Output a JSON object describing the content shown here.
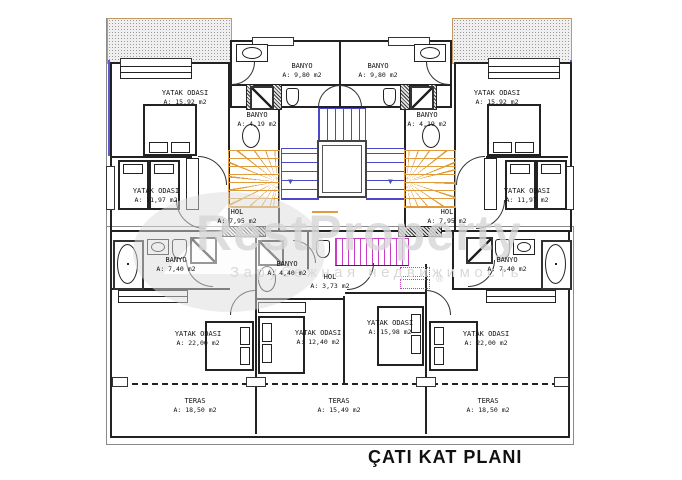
{
  "title": "ÇATI KAT PLANI",
  "watermark": {
    "brand": "RestProperty",
    "subtitle": "Зарубежная недвижимость",
    "registered": "®"
  },
  "colors": {
    "wall": "#222222",
    "stair_blue": "#4a4ac8",
    "stair_orange": "#e09c3c",
    "stair_magenta": "#c83cc8",
    "roof_hatch_edge": "#c49a64",
    "watermark_gray": "#d7d7d7"
  },
  "stairs": {
    "down_arrow": "▼"
  },
  "rooms": [
    {
      "id": "banyo-ust-sol",
      "name": "BANYO",
      "area": "A: 9,80 m2"
    },
    {
      "id": "banyo-ust-sag",
      "name": "BANYO",
      "area": "A: 9,80 m2"
    },
    {
      "id": "yatak-odasi-ust-sol",
      "name": "YATAK ODASI",
      "area": "A: 15,92 m2"
    },
    {
      "id": "yatak-odasi-ust-sag",
      "name": "YATAK ODASI",
      "area": "A: 15,92 m2"
    },
    {
      "id": "banyo-419-sol",
      "name": "BANYO",
      "area": "A: 4,19 m2"
    },
    {
      "id": "banyo-419-sag",
      "name": "BANYO",
      "area": "A: 4,19 m2"
    },
    {
      "id": "yatak-odasi-1197-sol",
      "name": "YATAK ODASI",
      "area": "A: 11,97 m2"
    },
    {
      "id": "yatak-odasi-1197-sag",
      "name": "YATAK ODASI",
      "area": "A: 11,97 m2"
    },
    {
      "id": "hol-795-sol",
      "name": "HOL",
      "area": "A: 7,95 m2"
    },
    {
      "id": "hol-795-sag",
      "name": "HOL",
      "area": "A: 7,95 m2"
    },
    {
      "id": "banyo-740-sol",
      "name": "BANYO",
      "area": "A: 7,40 m2"
    },
    {
      "id": "banyo-740-sag",
      "name": "BANYO",
      "area": "A: 7,40 m2"
    },
    {
      "id": "banyo-440",
      "name": "BANYO",
      "area": "A: 4,40 m2"
    },
    {
      "id": "hol-373",
      "name": "HOL",
      "area": "A: 3,73 m2"
    },
    {
      "id": "yatak-odasi-2200-sol",
      "name": "YATAK ODASI",
      "area": "A: 22,00 m2"
    },
    {
      "id": "yatak-odasi-1240",
      "name": "YATAK ODASI",
      "area": "A: 12,40 m2"
    },
    {
      "id": "yatak-odasi-1598",
      "name": "YATAK ODASI",
      "area": "A: 15,98 m2"
    },
    {
      "id": "yatak-odasi-2200-sag",
      "name": "YATAK ODASI",
      "area": "A: 22,00 m2"
    },
    {
      "id": "teras-1850-sol",
      "name": "TERAS",
      "area": "A: 18,50 m2"
    },
    {
      "id": "teras-1549",
      "name": "TERAS",
      "area": "A: 15,49 m2"
    },
    {
      "id": "teras-1850-sag",
      "name": "TERAS",
      "area": "A: 18,50 m2"
    }
  ]
}
